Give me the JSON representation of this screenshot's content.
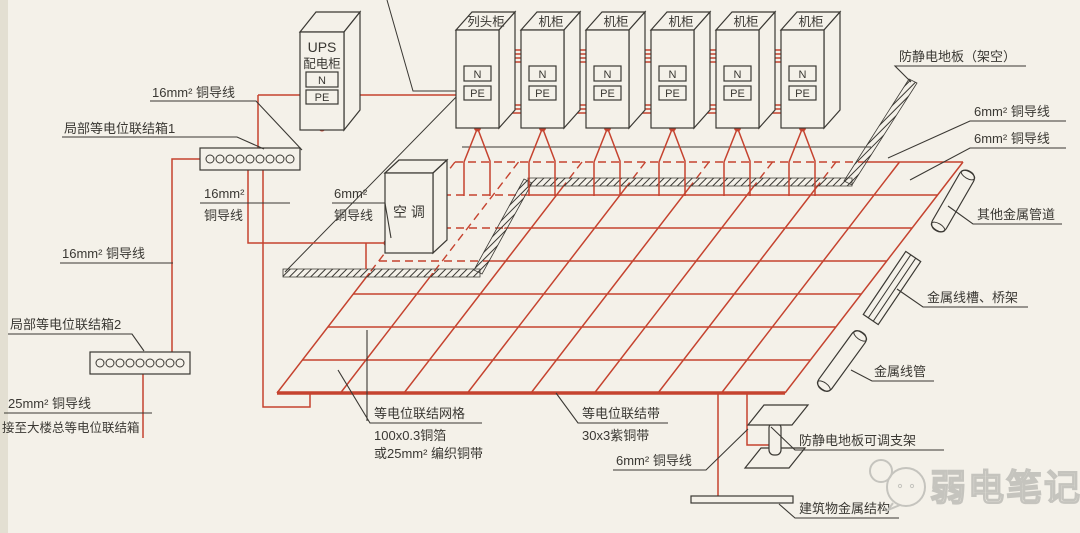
{
  "colors": {
    "bg": "#f4f1e9",
    "ink": "#3a3833",
    "wire": "#c5432f",
    "watermark": "#c5c4be",
    "paper_edge": "#ded8c9"
  },
  "cabinet_row": {
    "labels": [
      "列头柜",
      "机柜",
      "机柜",
      "机柜",
      "机柜",
      "机柜"
    ],
    "terminal_n": "N",
    "terminal_pe": "PE"
  },
  "ups": {
    "name_line1": "UPS",
    "name_line2": "配电柜",
    "terminal_n": "N",
    "terminal_pe": "PE"
  },
  "ac_unit": {
    "label": "空 调"
  },
  "bonding_boxes": {
    "box1": "局部等电位联结箱1",
    "box2": "局部等电位联结箱2"
  },
  "wire_labels": {
    "w16_top": "16mm² 铜导线",
    "w16_mid_line1": "16mm²",
    "w16_mid_line2": "铜导线",
    "w6_ac_line1": "6mm²",
    "w6_ac_line2": "铜导线",
    "w16_left": "16mm² 铜导线",
    "w25_line1": "25mm² 铜导线",
    "w25_line2": "接至大楼总等电位联结箱",
    "w6_right_1": "6mm² 铜导线",
    "w6_right_2": "6mm² 铜导线",
    "w6_bottom": "6mm² 铜导线"
  },
  "floor_labels": {
    "antistatic_floor": "防静电地板（架空）",
    "pedestal": "防静电地板可调支架"
  },
  "metal_labels": {
    "other_pipes": "其他金属管道",
    "tray": "金属线槽、桥架",
    "conduit": "金属线管",
    "building": "建筑物金属结构"
  },
  "grid_labels": {
    "mesh_line1": "等电位联结网格",
    "mesh_line2": "100x0.3铜箔",
    "mesh_line3": "或25mm² 编织铜带",
    "band_line1": "等电位联结带",
    "band_line2": "30x3紫铜带"
  },
  "watermark": {
    "text": "弱电笔记"
  }
}
